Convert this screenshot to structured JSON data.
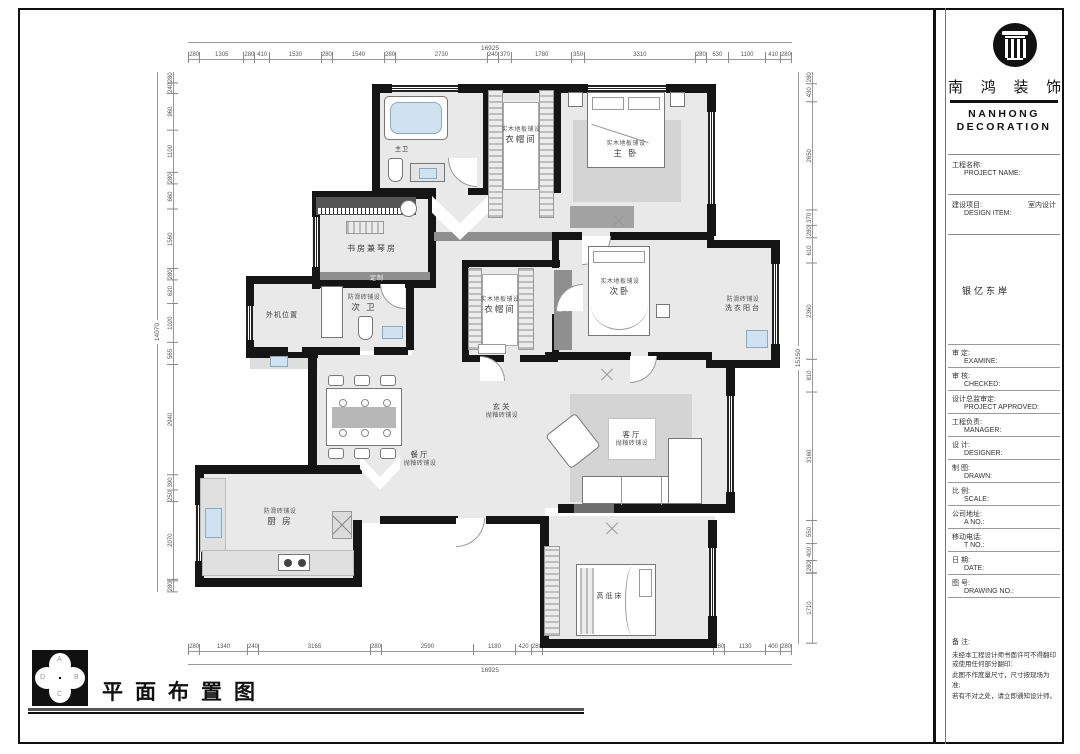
{
  "plan": {
    "dims": {
      "top": {
        "overall": "16925",
        "segments": [
          280,
          1305,
          280,
          410,
          1530,
          280,
          1540,
          280,
          2730,
          240,
          370,
          1780,
          350,
          3310,
          280,
          630,
          1100,
          410,
          280
        ]
      },
      "bottom": {
        "overall": "16925",
        "segments": [
          280,
          1340,
          240,
          3165,
          280,
          2590,
          1180,
          420,
          280,
          4860,
          280,
          1130,
          400,
          280
        ]
      },
      "left": {
        "overall": "14070",
        "segments": [
          280,
          240,
          960,
          1100,
          280,
          660,
          1560,
          280,
          620,
          1020,
          565,
          2940,
          390,
          250,
          2070,
          280
        ]
      },
      "right": {
        "overall": "15150",
        "segments": [
          280,
          430,
          2650,
          370,
          280,
          610,
          2360,
          810,
          3160,
          550,
          400,
          280,
          1710
        ]
      }
    },
    "rooms": {
      "master_bath": {
        "name": "主卫"
      },
      "cloak1": {
        "finish": "实木地板铺设",
        "name": "衣帽间"
      },
      "master": {
        "finish": "实木地板铺设",
        "name": "主 卧"
      },
      "study": {
        "name": "书房兼琴房"
      },
      "ac": {
        "name": "外机位置"
      },
      "bath2": {
        "finish": "防滑砖铺设",
        "name": "次 卫"
      },
      "cloak2": {
        "finish": "实木地板铺设",
        "name": "衣帽间"
      },
      "bed2": {
        "finish": "实木地板铺设",
        "name": "次卧"
      },
      "laundry": {
        "finish": "防滑砖铺设",
        "name": "洗衣阳台"
      },
      "entry": {
        "name": "玄关",
        "finish": "抛釉砖铺设"
      },
      "dining": {
        "name": "餐厅",
        "finish": "抛釉砖铺设"
      },
      "living": {
        "name": "客厅",
        "finish": "抛釉砖铺设"
      },
      "kitchen": {
        "finish": "防滑砖铺设",
        "name": "厨 房"
      },
      "bunk": {
        "name": "高低床"
      }
    },
    "annotations": {
      "custom": "定制"
    }
  },
  "title_block": {
    "company_cn": "南 鸿 装 饰",
    "company_en_line1": "NANHONG",
    "company_en_line2": "DECORATION",
    "project_label_cn": "工程名称:",
    "project_label_en": "PROJECT NAME:",
    "design_item_cn": "建设项目:",
    "design_item_en": "DESIGN ITEM:",
    "design_item_value": "室内设计",
    "project_title": "银亿东岸",
    "fields": [
      {
        "cn": "审  定:",
        "en": "EXAMINE:"
      },
      {
        "cn": "审  核:",
        "en": "CHECKED:"
      },
      {
        "cn": "设计总监审定:",
        "en": "PROJECT APPROVED:"
      },
      {
        "cn": "工程负责:",
        "en": "MANAGER:"
      },
      {
        "cn": "设  计:",
        "en": "DESIGNER:"
      },
      {
        "cn": "制  图:",
        "en": "DRAWN:"
      },
      {
        "cn": "比  例:",
        "en": "SCALE:"
      },
      {
        "cn": "公司地址:",
        "en": "A  NO.:"
      },
      {
        "cn": "移动电话:",
        "en": "T  NO.:"
      },
      {
        "cn": "日  期:",
        "en": "DATE:"
      },
      {
        "cn": "图  号:",
        "en": "DRAWING NO.:"
      }
    ],
    "remarks_label": "备  注:",
    "remarks": [
      "未经本工程设计师书面许可不得翻印或使用任何部分翻印;",
      "此图不作度量尺寸，尺寸按现场为准;",
      "若有不对之处，请立即通知设计师。"
    ]
  },
  "footer": {
    "title": "平面布置图",
    "compass": {
      "n": "A",
      "e": "B",
      "s": "C",
      "w": "D"
    }
  }
}
